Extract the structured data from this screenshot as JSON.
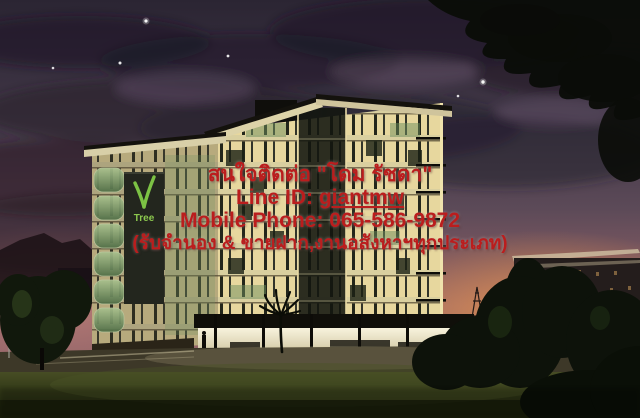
{
  "watermark": {
    "contact_line": "สนใจติดต่อ \"โดม รัชดา\"",
    "line_id_label": "Line ID: ",
    "line_id_value": "giantmw",
    "phone_line": "Mobile Phone: 065-586-9872",
    "services_line": "(รับจำนอง & ขายฝาก,งานอสังหาฯทุกประเภท)",
    "text_color": "#bb1d1d"
  },
  "building_sign": {
    "logo_text": "Tree",
    "logo_color": "#7cc244",
    "sign_panel_color": "#23261e"
  },
  "palette": {
    "sky_top": "#2b2533",
    "sky_purple": "#5c4a58",
    "horizon_pink": "#b5767a",
    "horizon_orange": "#d9894c",
    "window_glow": "#e7d79e",
    "facade_cream": "#d9cf9f",
    "glass_green": "#7a9a68",
    "grass_dark": "#2a3014"
  }
}
